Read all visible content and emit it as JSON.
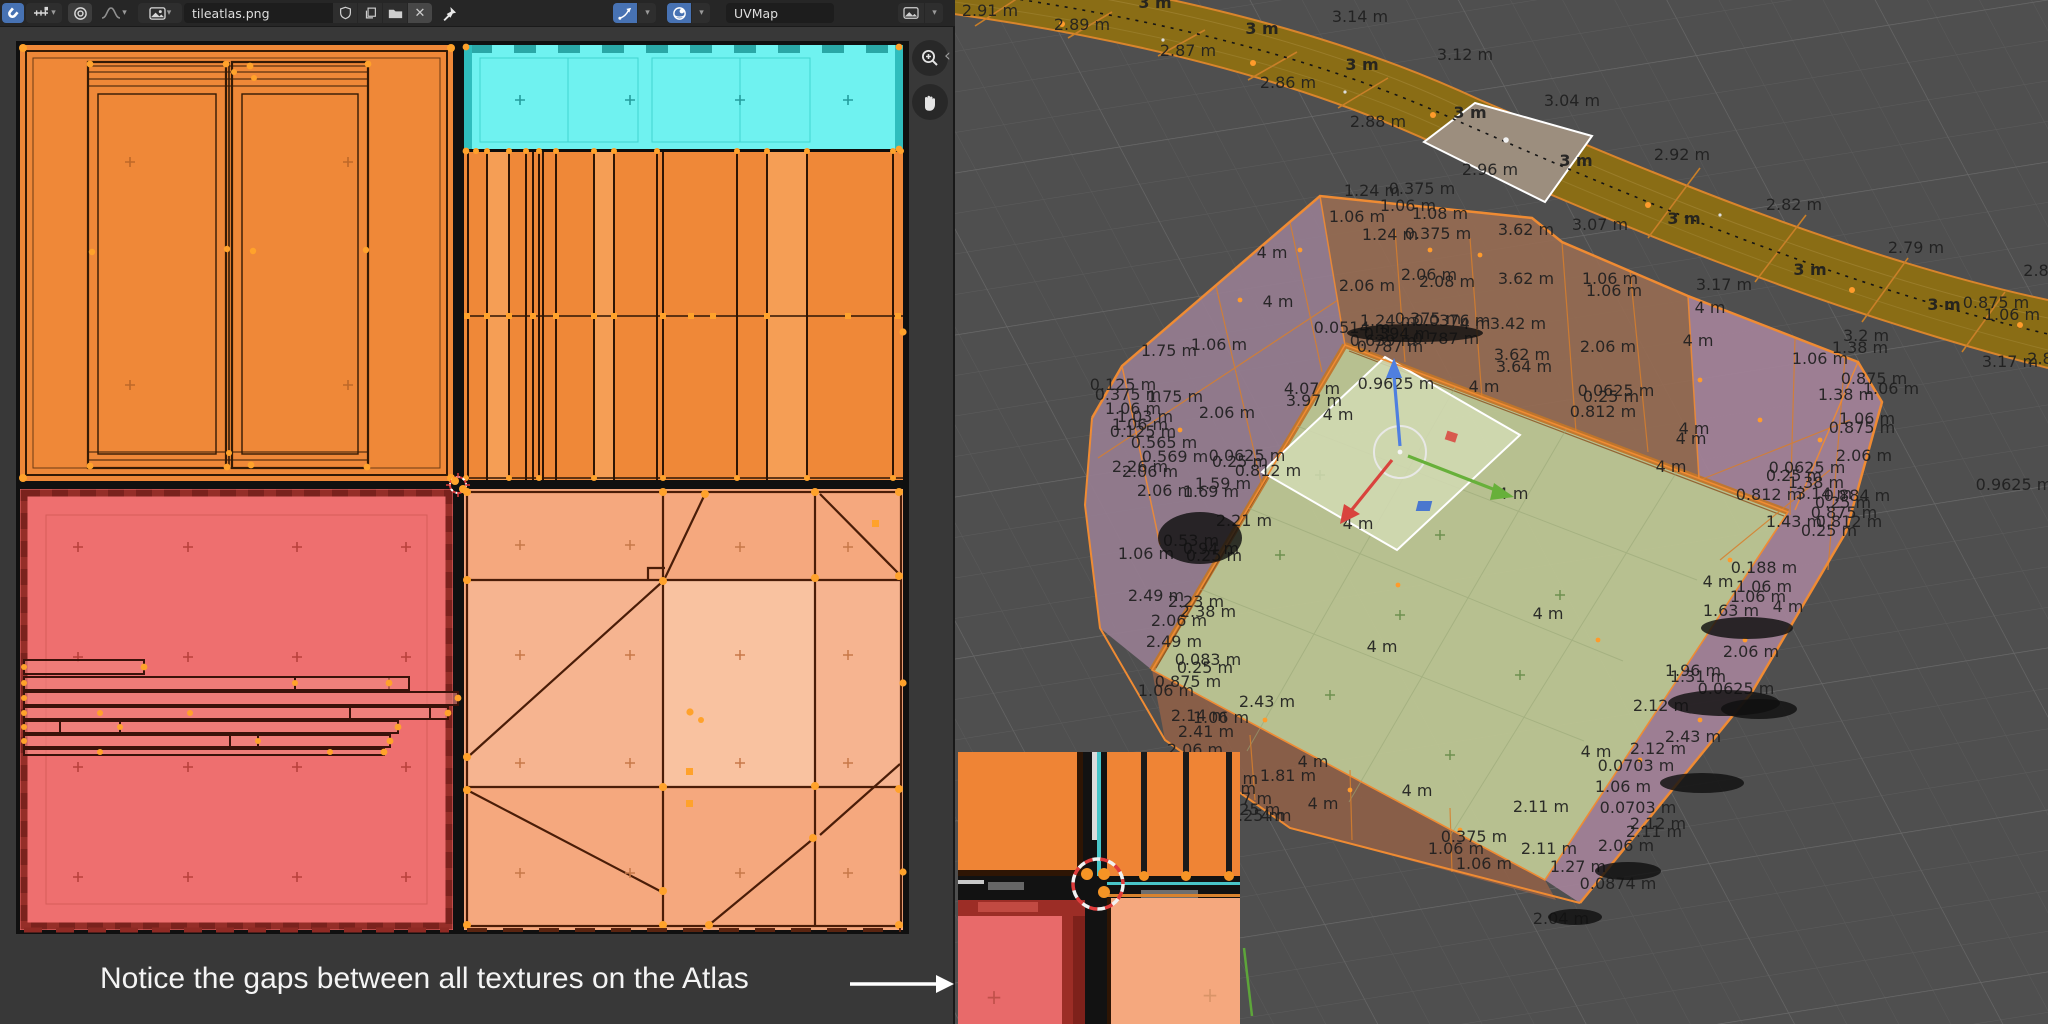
{
  "uv_editor": {
    "header": {
      "image_name": "tileatlas.png",
      "uvmap_name": "UVMap"
    },
    "annotation": {
      "text": "Notice the gaps between all textures on the Atlas"
    },
    "colors": {
      "atlas_orange": "#ef8838",
      "atlas_cyan": "#6ff2f0",
      "atlas_red": "#ee6f6f",
      "atlas_salmon": "#f5a87e",
      "accent_blue": "#4772b3",
      "selected_vertex_orange": "#ff9b2b"
    }
  },
  "viewport": {
    "colors": {
      "background": "#4f4f4f",
      "road_olive": "#8a6d15",
      "selected_face": "#9c8e7e",
      "floor_green": "#bdc694",
      "wall_mauve": "#967d90",
      "wall_brown": "#966b52",
      "wall_pink": "#a5839a",
      "edge_orange": "#ef8b33"
    },
    "labels": [
      {
        "t": "2.91 m",
        "x": 990,
        "y": 16
      },
      {
        "t": "3 m",
        "x": 1155,
        "y": 8,
        "b": 1
      },
      {
        "t": "2.89 m",
        "x": 1082,
        "y": 30
      },
      {
        "t": "3.14 m",
        "x": 1360,
        "y": 22
      },
      {
        "t": "2.87 m",
        "x": 1188,
        "y": 56
      },
      {
        "t": "3 m",
        "x": 1262,
        "y": 34,
        "b": 1
      },
      {
        "t": "3.12 m",
        "x": 1465,
        "y": 60
      },
      {
        "t": "2.86 m",
        "x": 1288,
        "y": 88
      },
      {
        "t": "3 m",
        "x": 1362,
        "y": 70,
        "b": 1
      },
      {
        "t": "2.88 m",
        "x": 1378,
        "y": 127
      },
      {
        "t": "3 m",
        "x": 1470,
        "y": 118,
        "b": 1
      },
      {
        "t": "3.04 m",
        "x": 1572,
        "y": 106
      },
      {
        "t": "2.96 m",
        "x": 1490,
        "y": 175
      },
      {
        "t": "3 m",
        "x": 1576,
        "y": 166,
        "b": 1
      },
      {
        "t": "2.92 m",
        "x": 1682,
        "y": 160
      },
      {
        "t": "3.07 m",
        "x": 1600,
        "y": 230
      },
      {
        "t": "3 m",
        "x": 1684,
        "y": 224,
        "b": 1
      },
      {
        "t": "2.82 m",
        "x": 1794,
        "y": 210
      },
      {
        "t": "2.79 m",
        "x": 1916,
        "y": 253
      },
      {
        "t": "3 m",
        "x": 1810,
        "y": 275,
        "b": 1
      },
      {
        "t": "3.17 m",
        "x": 1724,
        "y": 290
      },
      {
        "t": "3.2 m",
        "x": 1866,
        "y": 341
      },
      {
        "t": "3 m",
        "x": 1944,
        "y": 310,
        "b": 1
      },
      {
        "t": "2.8",
        "x": 2036,
        "y": 276
      },
      {
        "t": "3.17 m",
        "x": 2010,
        "y": 367
      },
      {
        "t": "2.8",
        "x": 2040,
        "y": 364
      },
      {
        "t": "1.24 m",
        "x": 1372,
        "y": 196
      },
      {
        "t": "0.375 m",
        "x": 1422,
        "y": 194
      },
      {
        "t": "1.06 m",
        "x": 1357,
        "y": 222
      },
      {
        "t": "1.06 m",
        "x": 1408,
        "y": 211
      },
      {
        "t": "1.08 m",
        "x": 1440,
        "y": 219
      },
      {
        "t": "1.24 m",
        "x": 1390,
        "y": 240
      },
      {
        "t": "0.375 m",
        "x": 1438,
        "y": 239
      },
      {
        "t": "3.62 m",
        "x": 1526,
        "y": 235
      },
      {
        "t": "3.62 m",
        "x": 1526,
        "y": 284
      },
      {
        "t": "1.06 m",
        "x": 1614,
        "y": 296
      },
      {
        "t": "4 m",
        "x": 1710,
        "y": 313
      },
      {
        "t": "4 m",
        "x": 1272,
        "y": 258
      },
      {
        "t": "2.06 m",
        "x": 1367,
        "y": 291
      },
      {
        "t": "2.06 m",
        "x": 1429,
        "y": 280
      },
      {
        "t": "2.08 m",
        "x": 1447,
        "y": 287
      },
      {
        "t": "4 m",
        "x": 1278,
        "y": 307
      },
      {
        "t": "1.75 m",
        "x": 1169,
        "y": 356
      },
      {
        "t": "1.06 m",
        "x": 1219,
        "y": 350
      },
      {
        "t": "0.0514 m",
        "x": 1352,
        "y": 333
      },
      {
        "t": "1.24 m",
        "x": 1388,
        "y": 326
      },
      {
        "t": "0.375 m",
        "x": 1428,
        "y": 324
      },
      {
        "t": "0.0376 m",
        "x": 1452,
        "y": 326
      },
      {
        "t": "4 m",
        "x": 1475,
        "y": 329
      },
      {
        "t": "0.394 m",
        "x": 1397,
        "y": 339
      },
      {
        "t": "0.787 m",
        "x": 1446,
        "y": 344
      },
      {
        "t": "0.639 m",
        "x": 1383,
        "y": 346
      },
      {
        "t": "0.787 m",
        "x": 1390,
        "y": 352
      },
      {
        "t": "3.42 m",
        "x": 1518,
        "y": 329
      },
      {
        "t": "3.62 m",
        "x": 1522,
        "y": 360
      },
      {
        "t": "3.64 m",
        "x": 1524,
        "y": 372
      },
      {
        "t": "4 m",
        "x": 1484,
        "y": 392
      },
      {
        "t": "0.9625 m",
        "x": 1396,
        "y": 389
      },
      {
        "t": "0.125 m",
        "x": 1123,
        "y": 390
      },
      {
        "t": "0.375 m",
        "x": 1128,
        "y": 400
      },
      {
        "t": "1.75 m",
        "x": 1175,
        "y": 402
      },
      {
        "t": "1.06 m",
        "x": 1133,
        "y": 414
      },
      {
        "t": "1.03 m",
        "x": 1145,
        "y": 422
      },
      {
        "t": "1.06 m",
        "x": 1140,
        "y": 430
      },
      {
        "t": "0.125 m",
        "x": 1143,
        "y": 437
      },
      {
        "t": "0.565 m",
        "x": 1164,
        "y": 448
      },
      {
        "t": "0.569 m",
        "x": 1175,
        "y": 462
      },
      {
        "t": "2.06 m",
        "x": 1227,
        "y": 418
      },
      {
        "t": "0.0625 m",
        "x": 1247,
        "y": 461
      },
      {
        "t": "0.25 m",
        "x": 1240,
        "y": 467
      },
      {
        "t": "0.812 m",
        "x": 1268,
        "y": 476
      },
      {
        "t": "4.07 m",
        "x": 1312,
        "y": 394
      },
      {
        "t": "3.97 m",
        "x": 1314,
        "y": 406
      },
      {
        "t": "4 m",
        "x": 1338,
        "y": 420
      },
      {
        "t": "2.26 m",
        "x": 1140,
        "y": 472
      },
      {
        "t": "2.06 m",
        "x": 1150,
        "y": 477
      },
      {
        "t": "1.06 m",
        "x": 1610,
        "y": 284
      },
      {
        "t": "2.06 m",
        "x": 1608,
        "y": 352
      },
      {
        "t": "4 m",
        "x": 1698,
        "y": 346
      },
      {
        "t": "0.0625 m",
        "x": 1616,
        "y": 396
      },
      {
        "t": "0.25 m",
        "x": 1611,
        "y": 402
      },
      {
        "t": "0.812 m",
        "x": 1603,
        "y": 417
      },
      {
        "t": "4 m",
        "x": 1694,
        "y": 434
      },
      {
        "t": "4 m",
        "x": 1691,
        "y": 444
      },
      {
        "t": "4 m",
        "x": 1671,
        "y": 472
      },
      {
        "t": "1.06 m",
        "x": 1820,
        "y": 364
      },
      {
        "t": "1.38 m",
        "x": 1860,
        "y": 353
      },
      {
        "t": "0.875 m",
        "x": 1874,
        "y": 384
      },
      {
        "t": "1.06 m",
        "x": 1891,
        "y": 394
      },
      {
        "t": "1.38 m",
        "x": 1846,
        "y": 400
      },
      {
        "t": "0.875 m",
        "x": 1996,
        "y": 308
      },
      {
        "t": "1.06 m",
        "x": 2012,
        "y": 320
      },
      {
        "t": "1.06 m",
        "x": 1867,
        "y": 424
      },
      {
        "t": "0.875 m",
        "x": 1862,
        "y": 433
      },
      {
        "t": "2.06 m",
        "x": 1864,
        "y": 461
      },
      {
        "t": "0.0625 m",
        "x": 1807,
        "y": 473
      },
      {
        "t": "0.25 m",
        "x": 1794,
        "y": 481
      },
      {
        "t": "1.38 m",
        "x": 1816,
        "y": 488
      },
      {
        "t": "0.812 m",
        "x": 1769,
        "y": 500
      },
      {
        "t": "3.14 m",
        "x": 1824,
        "y": 499
      },
      {
        "t": "0.884 m",
        "x": 1857,
        "y": 501
      },
      {
        "t": "0.25 m",
        "x": 1843,
        "y": 508
      },
      {
        "t": "0.875 m",
        "x": 1844,
        "y": 518
      },
      {
        "t": "0.812 m",
        "x": 1849,
        "y": 527
      },
      {
        "t": "1.43 m",
        "x": 1794,
        "y": 527
      },
      {
        "t": "0.25 m",
        "x": 1829,
        "y": 536
      },
      {
        "t": "0.9625 m",
        "x": 2014,
        "y": 490
      },
      {
        "t": "2.06 m",
        "x": 1165,
        "y": 496
      },
      {
        "t": "1.69 m",
        "x": 1211,
        "y": 497
      },
      {
        "t": "1.59 m",
        "x": 1223,
        "y": 489
      },
      {
        "t": "2.21 m",
        "x": 1244,
        "y": 526
      },
      {
        "t": "0.53 m",
        "x": 1191,
        "y": 546
      },
      {
        "t": "0.94 m",
        "x": 1211,
        "y": 554
      },
      {
        "t": "1.06 m",
        "x": 1146,
        "y": 559
      },
      {
        "t": "0.25 m",
        "x": 1214,
        "y": 561
      },
      {
        "t": "2.49 m",
        "x": 1156,
        "y": 601
      },
      {
        "t": "2.23 m",
        "x": 1196,
        "y": 607
      },
      {
        "t": "2.38 m",
        "x": 1208,
        "y": 617
      },
      {
        "t": "2.06 m",
        "x": 1179,
        "y": 626
      },
      {
        "t": "2.49 m",
        "x": 1174,
        "y": 647
      },
      {
        "t": "0.083 m",
        "x": 1208,
        "y": 665
      },
      {
        "t": "0.25 m",
        "x": 1205,
        "y": 673
      },
      {
        "t": "0.875 m",
        "x": 1188,
        "y": 687
      },
      {
        "t": "1.06 m",
        "x": 1166,
        "y": 696
      },
      {
        "t": "2.43 m",
        "x": 1267,
        "y": 707
      },
      {
        "t": "2.14 m",
        "x": 1199,
        "y": 721
      },
      {
        "t": "1.06 m",
        "x": 1221,
        "y": 723
      },
      {
        "t": "2.41 m",
        "x": 1206,
        "y": 737
      },
      {
        "t": "2.06 m",
        "x": 1195,
        "y": 755
      },
      {
        "t": "4 m",
        "x": 1513,
        "y": 499
      },
      {
        "t": "4 m",
        "x": 1358,
        "y": 529
      },
      {
        "t": "4 m",
        "x": 1382,
        "y": 652
      },
      {
        "t": "4 m",
        "x": 1548,
        "y": 619
      },
      {
        "t": "4 m",
        "x": 1313,
        "y": 767
      },
      {
        "t": "1.81 m",
        "x": 1288,
        "y": 781
      },
      {
        "t": "1.06 m",
        "x": 1230,
        "y": 784
      },
      {
        "t": "1.06 m",
        "x": 1228,
        "y": 794
      },
      {
        "t": "0.57 m",
        "x": 1244,
        "y": 804
      },
      {
        "t": "0.0625 m",
        "x": 1242,
        "y": 815
      },
      {
        "t": "0.25 m",
        "x": 1256,
        "y": 821
      },
      {
        "t": "4 m",
        "x": 1276,
        "y": 821
      },
      {
        "t": "4 m",
        "x": 1323,
        "y": 809
      },
      {
        "t": "4 m",
        "x": 1417,
        "y": 796
      },
      {
        "t": "2.11 m",
        "x": 1541,
        "y": 812
      },
      {
        "t": "0.375 m",
        "x": 1474,
        "y": 842
      },
      {
        "t": "1.06 m",
        "x": 1456,
        "y": 854
      },
      {
        "t": "2.11 m",
        "x": 1549,
        "y": 854
      },
      {
        "t": "1.06 m",
        "x": 1484,
        "y": 869
      },
      {
        "t": "0.188 m",
        "x": 1764,
        "y": 573
      },
      {
        "t": "4 m",
        "x": 1718,
        "y": 587
      },
      {
        "t": "1.06 m",
        "x": 1764,
        "y": 592
      },
      {
        "t": "1.06 m",
        "x": 1758,
        "y": 602
      },
      {
        "t": "1.63 m",
        "x": 1731,
        "y": 616
      },
      {
        "t": "4 m",
        "x": 1788,
        "y": 612
      },
      {
        "t": "2.06 m",
        "x": 1751,
        "y": 657
      },
      {
        "t": "1.96 m",
        "x": 1693,
        "y": 676
      },
      {
        "t": "1.31 m",
        "x": 1698,
        "y": 682
      },
      {
        "t": "0.0625 m",
        "x": 1736,
        "y": 694
      },
      {
        "t": "2.12 m",
        "x": 1661,
        "y": 711
      },
      {
        "t": "2.43 m",
        "x": 1693,
        "y": 742
      },
      {
        "t": "2.12 m",
        "x": 1658,
        "y": 754
      },
      {
        "t": "4 m",
        "x": 1596,
        "y": 757
      },
      {
        "t": "0.0703 m",
        "x": 1636,
        "y": 771
      },
      {
        "t": "1.06 m",
        "x": 1623,
        "y": 792
      },
      {
        "t": "0.0703 m",
        "x": 1638,
        "y": 813
      },
      {
        "t": "2.12 m",
        "x": 1658,
        "y": 829
      },
      {
        "t": "2.11 m",
        "x": 1654,
        "y": 837
      },
      {
        "t": "2.06 m",
        "x": 1626,
        "y": 851
      },
      {
        "t": "1.27 m",
        "x": 1578,
        "y": 872
      },
      {
        "t": "0.0874 m",
        "x": 1618,
        "y": 889
      },
      {
        "t": "2.04 m",
        "x": 1561,
        "y": 924
      }
    ],
    "scribbles": [
      [
        1200,
        538,
        42,
        26
      ],
      [
        1415,
        333,
        68,
        9
      ],
      [
        1747,
        628,
        46,
        11
      ],
      [
        1724,
        703,
        56,
        13
      ],
      [
        1759,
        709,
        38,
        10
      ],
      [
        1702,
        783,
        42,
        10
      ],
      [
        1628,
        871,
        33,
        9
      ],
      [
        1575,
        917,
        27,
        8
      ]
    ]
  }
}
